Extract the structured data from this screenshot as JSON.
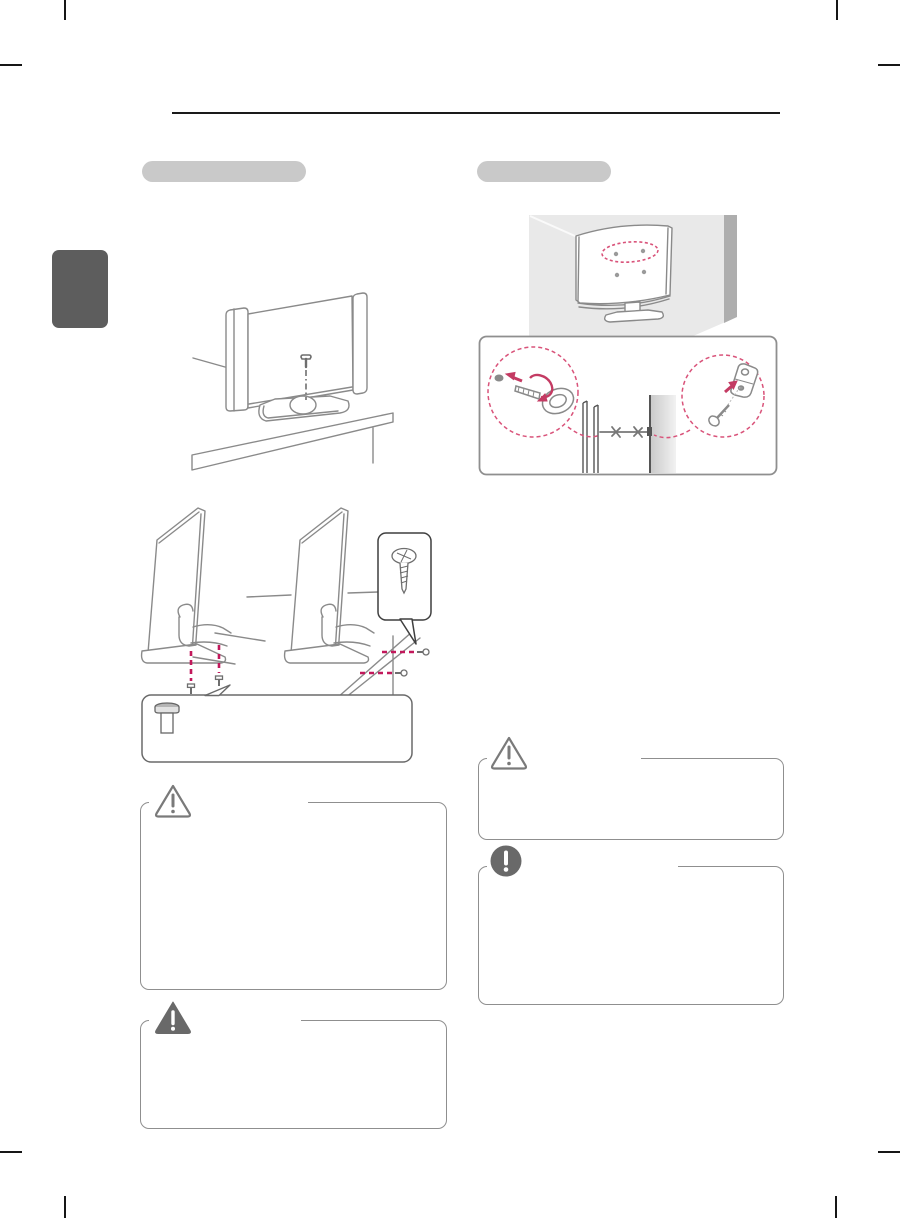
{
  "document": {
    "kind": "printed TV owner's manual page, all body text blank/redacted",
    "background": "#ffffff"
  },
  "header": {
    "rule_color": "#1a1a1a"
  },
  "side_tab": {
    "label": "",
    "color": "#5d5d5d"
  },
  "accent": {
    "pill_gray": "#c9c9c9",
    "line_art_gray": "#8a8a8a",
    "box_border_gray": "#8f8f8f",
    "icon_gray": "#696969",
    "pink_dash": "#d9537a",
    "red_dash": "#c2185b",
    "arrow_red": "#c43b63",
    "wall_gray": "#e9e9e9",
    "wall_band_gray": "#aeaeae"
  },
  "left_column": {
    "heading": {
      "label": ""
    },
    "figures": [
      {
        "name": "tv-on-table-with-securing-screw",
        "caption": ""
      },
      {
        "name": "stand-screw-fastening-two-views",
        "caption": ""
      }
    ],
    "notices": [
      {
        "icon": "caution-triangle-outline-icon",
        "title": "",
        "body": ""
      },
      {
        "icon": "warning-triangle-filled-icon",
        "title": "",
        "body": ""
      }
    ]
  },
  "right_column": {
    "heading": {
      "label": ""
    },
    "figures": [
      {
        "name": "tv-rear-wall-mount-holes",
        "caption": ""
      },
      {
        "name": "eyebolt-bracket-tether-detail",
        "caption": ""
      }
    ],
    "notices": [
      {
        "icon": "caution-triangle-outline-icon",
        "title": "",
        "body": ""
      },
      {
        "icon": "note-circle-filled-icon",
        "title": "",
        "body": ""
      }
    ]
  }
}
